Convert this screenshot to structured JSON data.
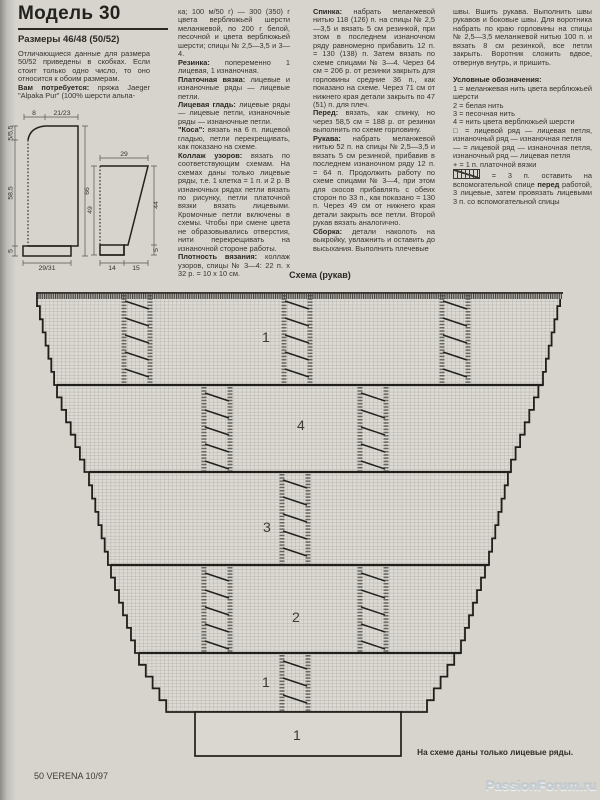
{
  "header": {
    "title": "Модель 30",
    "sizes": "Размеры 46/48 (50/52)"
  },
  "columns": {
    "col1": [
      {
        "runs": [
          {
            "t": "Отличающиеся данные для размера 50/52 приведены в скобках. Если стоит только одно число, то оно относится к обоим размерам."
          }
        ]
      },
      {
        "runs": [
          {
            "b": true,
            "t": "Вам потребуется:"
          },
          {
            "t": " пряжа Jaeger \"Alpaka Pur\" (100% шерсти альпа-"
          }
        ]
      }
    ],
    "col2": [
      {
        "runs": [
          {
            "t": "ка; 100 м/50 г) — 300 (350) г цвета верблюжьей шерсти меланжевой, по 200 г белой, песочной и цвета верблюжьей шерсти; спицы № 2,5—3,5 и 3—4."
          }
        ]
      },
      {
        "runs": [
          {
            "b": true,
            "t": "Резинка:"
          },
          {
            "t": " попеременно 1 лицевая, 1 изнаночная."
          }
        ]
      },
      {
        "runs": [
          {
            "b": true,
            "t": "Платочная вязка:"
          },
          {
            "t": " лицевые и изнаночные ряды — лицевые петли."
          }
        ]
      },
      {
        "runs": [
          {
            "b": true,
            "t": "Лицевая гладь:"
          },
          {
            "t": " лицевые ряды — лицевые петли, изнаночные ряды — изнаночные петли."
          }
        ]
      },
      {
        "runs": [
          {
            "b": true,
            "t": "\"Коса\":"
          },
          {
            "t": " вязать на 6 п. лицевой гладью, петли перекрещивать, как показано на схеме."
          }
        ]
      },
      {
        "runs": [
          {
            "b": true,
            "t": "Коллаж узоров:"
          },
          {
            "t": " вязать по соответствующим схемам. На схемах даны только лицевые ряды, т.е. 1 клетка = 1 п. и 2 р. В изнаночных рядах петли вязать по рисунку, петли платочной вязки вязать лицевыми. Кромочные петли включены в схемы. Чтобы при смене цвета не образовывались отверстия, нити перекрещивать на изнаночной стороне работы."
          }
        ]
      },
      {
        "runs": [
          {
            "b": true,
            "t": "Плотность вязания:"
          },
          {
            "t": " коллаж узоров, спицы № 3—4: 22 п. x 32 р. = 10 x 10 см."
          }
        ]
      }
    ],
    "col3": [
      {
        "runs": [
          {
            "b": true,
            "t": "Спинка:"
          },
          {
            "t": " набрать меланжевой нитью 118 (126) п. на спицы № 2,5—3,5 и вязать 5 см резинкой, при этом в последнем изнаночном ряду равномерно прибавить 12 п. = 130 (138) п. Затем вязать по схеме спицами № 3—4. Через 64 см = 206 р. от резинки закрыть для горловины средние 36 п., как показано на схеме. Через 71 см от нижнего края детали закрыть по 47 (51) п. для плеч."
          }
        ]
      },
      {
        "runs": [
          {
            "b": true,
            "t": "Перед:"
          },
          {
            "t": " вязать, как спинку, но через 58,5 см = 188 р. от резинки выполнить по схеме горловину."
          }
        ]
      },
      {
        "runs": [
          {
            "b": true,
            "t": "Рукава:"
          },
          {
            "t": " набрать меланжевой нитью 52 п. на спицы № 2,5—3,5 и вязать 5 см резинкой, прибавив в последнем изнаночном ряду 12 п. = 64 п. Продолжить работу по схеме спицами № 3—4, при этом для скосов прибавлять с обеих сторон по 33 п., как показано = 130 п. Через 49 см от нижнего края детали закрыть все петли. Второй рукав вязать аналогично."
          }
        ]
      },
      {
        "runs": [
          {
            "b": true,
            "t": "Сборка:"
          },
          {
            "t": " детали наколоть на выкройку, увлажнить и оставить до высыхания. Выполнить плечевые"
          }
        ]
      }
    ],
    "col4": [
      {
        "runs": [
          {
            "t": "швы. Вшить рукава. Выполнить швы рукавов и боковые швы. Для воротника набрать по краю горловины на спицы № 2,5—3,5 меланжевой нитью 100 п. и вязать 8 см резинкой, все петли закрыть. Воротник сложить вдвое, отвернув внутрь, и пришить."
          }
        ]
      },
      {
        "gap": true,
        "runs": [
          {
            "b": true,
            "t": "Условные обозначения:"
          }
        ]
      },
      {
        "runs": [
          {
            "t": "1 = меланжевая нить цвета верблюжьей шерсти"
          }
        ]
      },
      {
        "runs": [
          {
            "t": "2 = белая нить"
          }
        ]
      },
      {
        "runs": [
          {
            "t": "3 = песочная нить"
          }
        ]
      },
      {
        "runs": [
          {
            "t": "4 = нить цвета верблюжьей шерсти"
          }
        ]
      },
      {
        "runs": [
          {
            "t": "□ = лицевой ряд — лицевая петля, изнаночный ряд — изнаночная петля"
          }
        ]
      },
      {
        "runs": [
          {
            "t": "— = лицевой ряд — изнаночная петля, изнаночный ряд — лицевая петля"
          }
        ]
      },
      {
        "runs": [
          {
            "t": "+ = 1 п. платочной вязки"
          }
        ]
      },
      {
        "runs": [
          {
            "sym": "cable"
          },
          {
            "t": " = 3 п. оставить на вспомогательной спице "
          },
          {
            "b": true,
            "t": "перед"
          },
          {
            "t": " работой, 3 лицевые, затем провязать лицевыми 3 п. со вспомогательной спицы"
          }
        ]
      }
    ]
  },
  "schematic": {
    "body": {
      "neck_width": "8",
      "shoulder_width": "21/23",
      "neck_depth": "5/5,5",
      "side_length": "58,5",
      "rib_height": "5",
      "total_length": "66",
      "bottom_width": "29/31"
    },
    "sleeve": {
      "top_width": "29",
      "length": "49",
      "slope_length": "44",
      "rib_height": "5",
      "rib_width": "14",
      "slope_width": "15"
    }
  },
  "chart": {
    "title": "Схема (рукав)",
    "note": "На схеме даны только лицевые ряды.",
    "rib_label": "1",
    "bands": [
      {
        "label": "1",
        "cables": [
          137,
          297,
          455
        ]
      },
      {
        "label": "4",
        "cables": [
          217,
          373
        ]
      },
      {
        "label": "3",
        "cables": [
          295
        ]
      },
      {
        "label": "2",
        "cables": [
          217,
          373
        ]
      },
      {
        "label": "1",
        "cables": [
          295
        ]
      }
    ]
  },
  "footer": {
    "page": "50 VERENA 10/97",
    "watermark": "PassionForum.ru"
  }
}
